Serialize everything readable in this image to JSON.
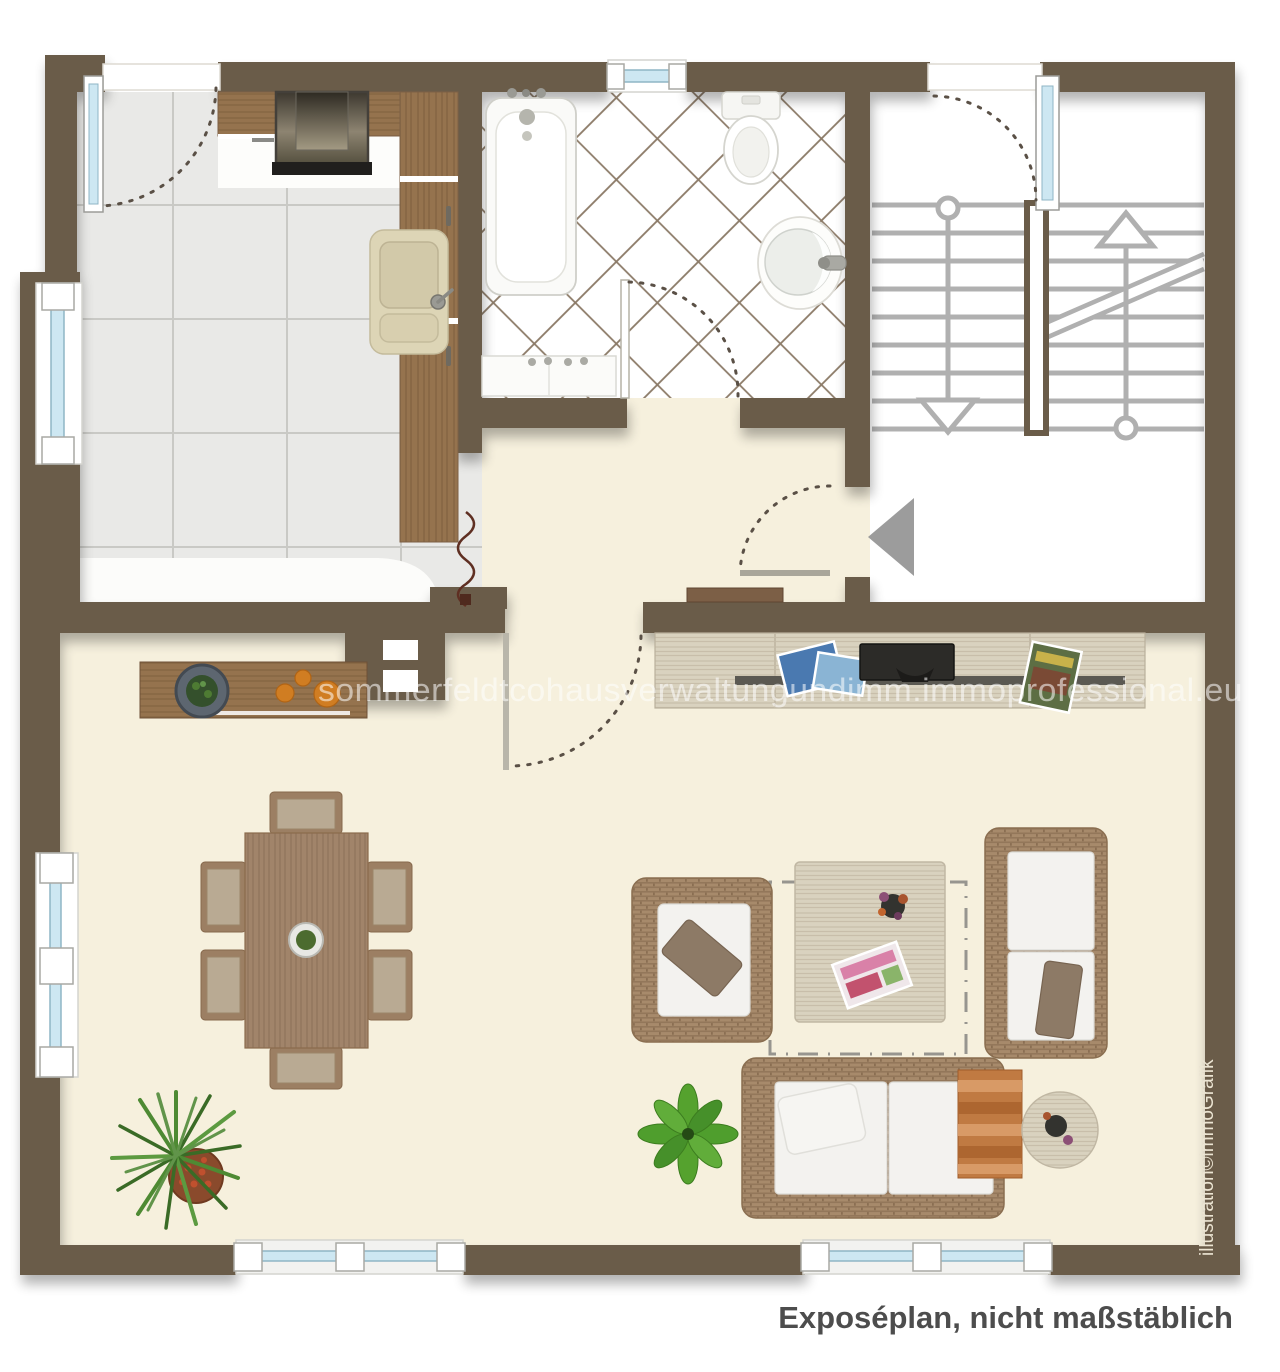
{
  "texts": {
    "watermark": "sommerfeldtcohausverwaltungundimm.immoprofessional.eu",
    "caption": "Exposéplan, nicht maßstäblich",
    "credit": "illustration©immoGrafik"
  },
  "palette": {
    "wall": "#6a5c49",
    "floor_living": "#f6f0dd",
    "floor_kitchen_tile": "#e9e9e7",
    "tile_grout": "#c9c9c5",
    "bath_tile_line": "#8b7a67",
    "window_glass": "#cde7f2",
    "wood_dark": "#95734e",
    "wood_dining": "#a1846a",
    "wood_light": "#d9d2bf",
    "wicker": "#a78a6b",
    "cushion": "#f3f2ef",
    "stair_line": "#b0b0b0",
    "entrance_arrow": "#9c9c9c",
    "door_swing": "#5a5046",
    "caption_text": "#4d4d4d",
    "credit_text": "#ece5d3",
    "orange_fruit": "#d07d22"
  },
  "icons": {
    "fixtures": [
      "bathtub-icon",
      "toilet-icon",
      "washbasin-icon",
      "kitchen-sink-icon",
      "cooker-hood-icon",
      "entrance-arrow-icon",
      "stairs-up-icon",
      "stairs-down-icon",
      "door-swing-icon",
      "window-icon"
    ],
    "furniture": [
      "kitchen-counter",
      "sideboard",
      "tv-lowboard",
      "tv",
      "hall-bench",
      "dining-table",
      "dining-chair",
      "armchair",
      "sofa",
      "loveseat",
      "coffee-table",
      "side-table",
      "rug-outline",
      "potted-plant"
    ]
  }
}
